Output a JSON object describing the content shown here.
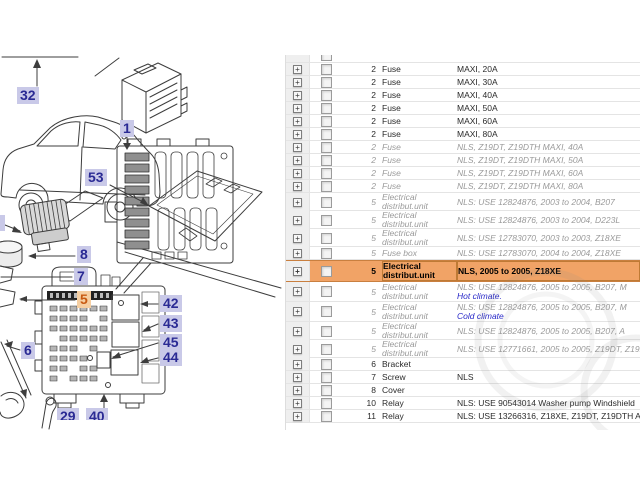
{
  "app": {
    "type": "parts-catalog-viewer"
  },
  "colors": {
    "selection_bg": "#f1a366",
    "selection_border": "#c97f3f",
    "callout_bg": "#c9c9e8",
    "callout_text": "#2a2a94",
    "callout_selected_bg": "#f6cfa2",
    "callout_selected_text": "#c85a12",
    "nls_text": "#9a9a9a",
    "link_text": "#2929c8",
    "row_line": "#e4e4e4",
    "expand_strip_bg": "#efefef"
  },
  "diagram": {
    "callouts": [
      {
        "label": "32",
        "x": 17,
        "y": 87
      },
      {
        "label": "1",
        "x": 120,
        "y": 120
      },
      {
        "label": "53",
        "x": 85,
        "y": 169
      },
      {
        "label": "8",
        "x": 77,
        "y": 246
      },
      {
        "label": "7",
        "x": 74,
        "y": 268
      },
      {
        "label": "5",
        "x": 77,
        "y": 291,
        "highlighted": true
      },
      {
        "label": "6",
        "x": 21,
        "y": 342
      },
      {
        "label": "42",
        "x": 160,
        "y": 295
      },
      {
        "label": "43",
        "x": 160,
        "y": 315
      },
      {
        "label": "45",
        "x": 160,
        "y": 334
      },
      {
        "label": "44",
        "x": 160,
        "y": 349
      },
      {
        "label": "29",
        "x": 57,
        "y": 408,
        "clipped": true
      },
      {
        "label": "40",
        "x": 86,
        "y": 408,
        "clipped": true
      }
    ]
  },
  "table": {
    "expand_icon": "plus-box-icon",
    "checkbox_state": "unchecked",
    "rows": [
      {
        "pos": "2",
        "name": "Fuse",
        "desc": "MAXI, 20A",
        "style": "normal"
      },
      {
        "pos": "2",
        "name": "Fuse",
        "desc": "MAXI, 30A",
        "style": "normal"
      },
      {
        "pos": "2",
        "name": "Fuse",
        "desc": "MAXI, 40A",
        "style": "normal"
      },
      {
        "pos": "2",
        "name": "Fuse",
        "desc": "MAXI, 50A",
        "style": "normal"
      },
      {
        "pos": "2",
        "name": "Fuse",
        "desc": "MAXI, 60A",
        "style": "normal"
      },
      {
        "pos": "2",
        "name": "Fuse",
        "desc": "MAXI, 80A",
        "style": "normal"
      },
      {
        "pos": "2",
        "name": "Fuse",
        "desc": "NLS, Z19DT, Z19DTH MAXI, 40A",
        "style": "nls"
      },
      {
        "pos": "2",
        "name": "Fuse",
        "desc": "NLS, Z19DT, Z19DTH MAXI, 50A",
        "style": "nls"
      },
      {
        "pos": "2",
        "name": "Fuse",
        "desc": "NLS, Z19DT, Z19DTH MAXI, 60A",
        "style": "nls"
      },
      {
        "pos": "2",
        "name": "Fuse",
        "desc": "NLS, Z19DT, Z19DTH MAXI, 80A",
        "style": "nls"
      },
      {
        "pos": "5",
        "name": "Electrical distribut.unit",
        "desc": "NLS: USE 12824876, 2003 to 2004, B207",
        "style": "nls"
      },
      {
        "pos": "5",
        "name": "Electrical distribut.unit",
        "desc": "NLS: USE 12824876, 2003 to 2004, D223L",
        "style": "nls"
      },
      {
        "pos": "5",
        "name": "Electrical distribut.unit",
        "desc": "NLS: USE 12783070, 2003 to 2003, Z18XE",
        "style": "nls"
      },
      {
        "pos": "5",
        "name": "Fuse box",
        "desc": "NLS: USE 12783070, 2004 to 2004, Z18XE",
        "style": "nls"
      },
      {
        "pos": "5",
        "name": "Electrical distribut.unit",
        "desc": "NLS, 2005 to 2005, Z18XE",
        "style": "selected"
      },
      {
        "pos": "5",
        "name": "Electrical distribut.unit",
        "desc": "NLS: USE 12824876, 2005 to 2005, B207, M",
        "desc2": "Hot climate.",
        "style": "nls"
      },
      {
        "pos": "5",
        "name": "Electrical distribut.unit",
        "desc": "NLS: USE 12824876, 2005 to 2005, B207, M",
        "desc2": "Cold climate",
        "style": "nls"
      },
      {
        "pos": "5",
        "name": "Electrical distribut.unit",
        "desc": "NLS: USE 12824876, 2005 to 2005, B207, A",
        "style": "nls"
      },
      {
        "pos": "5",
        "name": "Electrical distribut.unit",
        "desc": "NLS: USE 12771661, 2005 to 2005, Z19DT, Z19DTH",
        "style": "nls"
      },
      {
        "pos": "6",
        "name": "Bracket",
        "desc": "",
        "style": "normal"
      },
      {
        "pos": "7",
        "name": "Screw",
        "desc": "NLS",
        "style": "normal"
      },
      {
        "pos": "8",
        "name": "Cover",
        "desc": "",
        "style": "normal"
      },
      {
        "pos": "10",
        "name": "Relay",
        "desc": "NLS: USE 90543014 Washer pump Windshield",
        "style": "normal"
      },
      {
        "pos": "11",
        "name": "Relay",
        "desc": "NLS: USE 13266316, Z18XE, Z19DT, Z19DTH AC compressor",
        "style": "normal"
      }
    ]
  }
}
